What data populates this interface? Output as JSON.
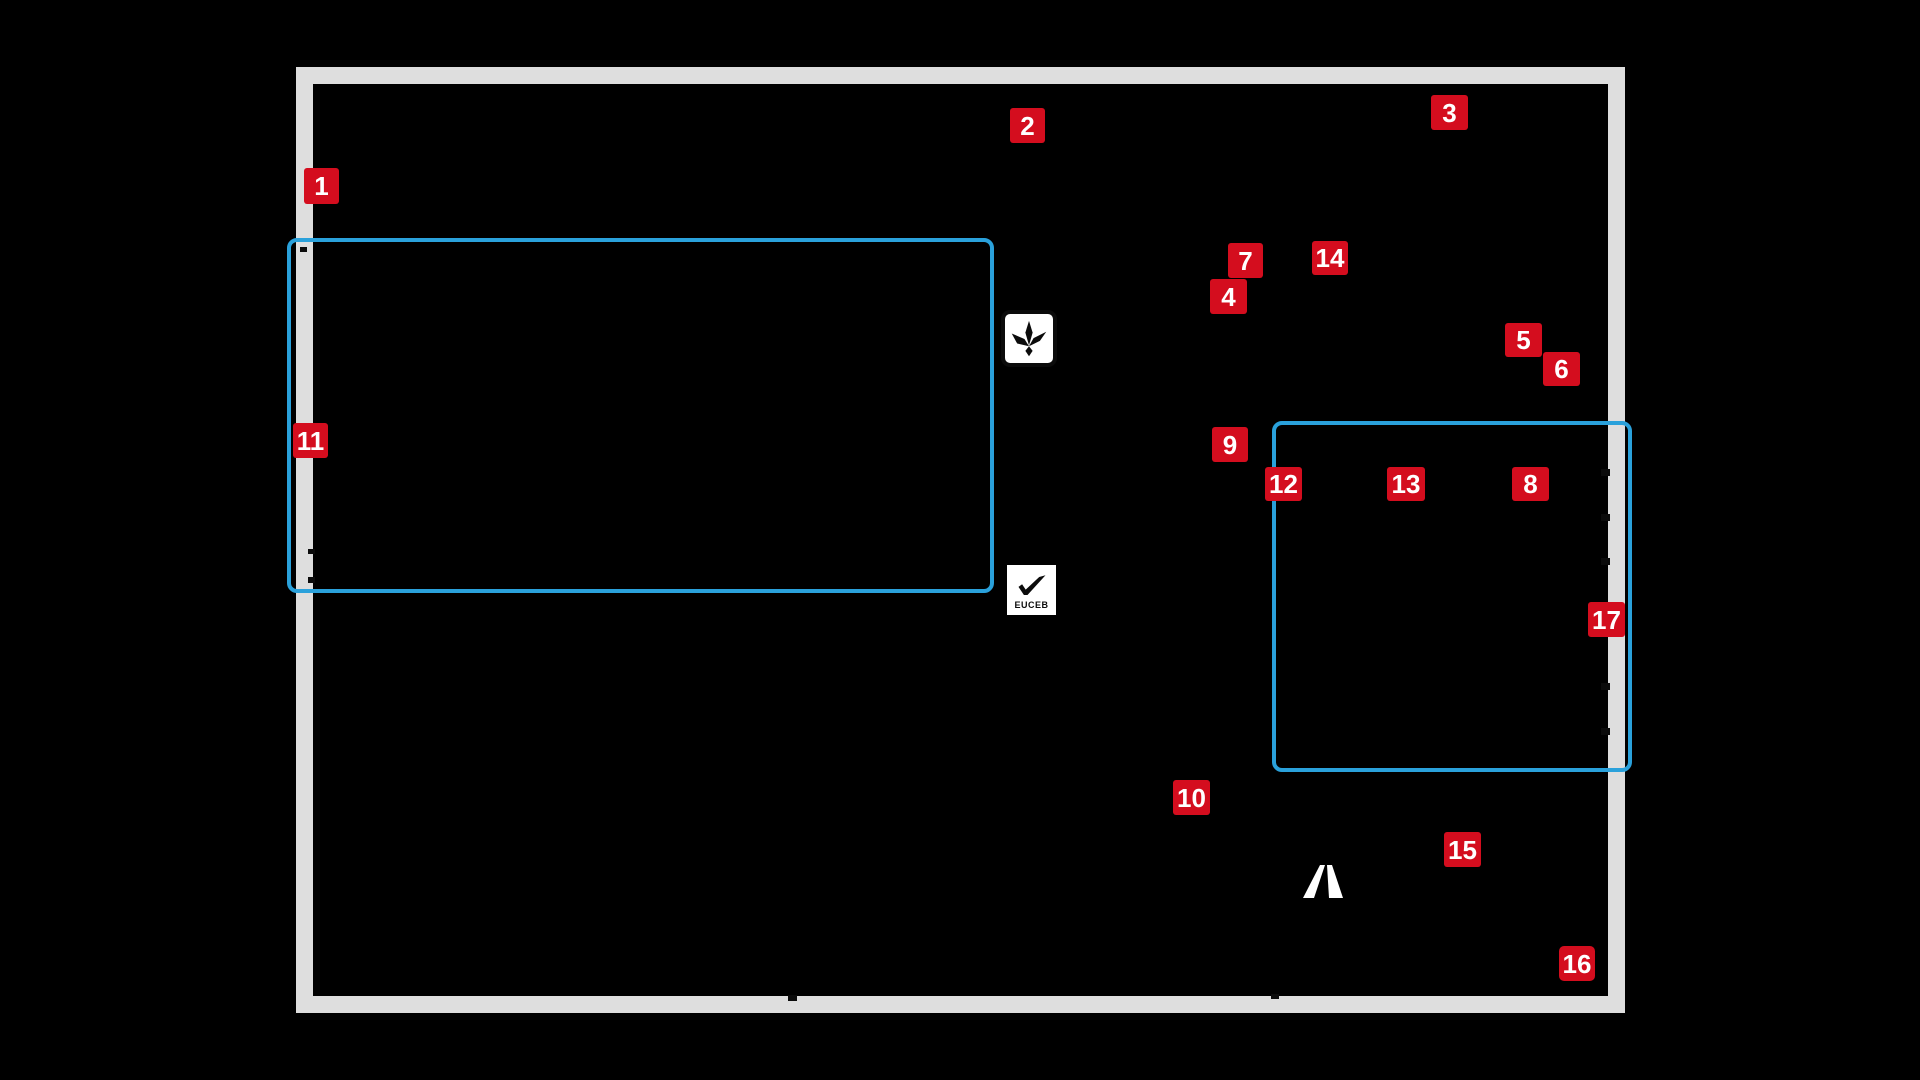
{
  "colors": {
    "background": "#000000",
    "frame_gray": "#dedede",
    "outline_blue": "#2aa1db",
    "badge_red": "#d40d1e",
    "badge_text": "#ffffff",
    "mark_black": "#0b0b0b",
    "mark_white": "#ffffff"
  },
  "badges": [
    {
      "label": "1"
    },
    {
      "label": "2"
    },
    {
      "label": "3"
    },
    {
      "label": "4"
    },
    {
      "label": "5"
    },
    {
      "label": "6"
    },
    {
      "label": "7"
    },
    {
      "label": "8"
    },
    {
      "label": "9"
    },
    {
      "label": "10"
    },
    {
      "label": "11"
    },
    {
      "label": "12"
    },
    {
      "label": "13"
    },
    {
      "label": "14"
    },
    {
      "label": "15"
    },
    {
      "label": "16"
    },
    {
      "label": "17"
    }
  ],
  "icons": {
    "eco_leaf": {
      "name": "leaf-certification-icon"
    },
    "euceb": {
      "name": "euceb-checkmark-icon",
      "label": "EUCEB"
    },
    "brand_mark": {
      "name": "letter-a-logo-mark"
    }
  }
}
